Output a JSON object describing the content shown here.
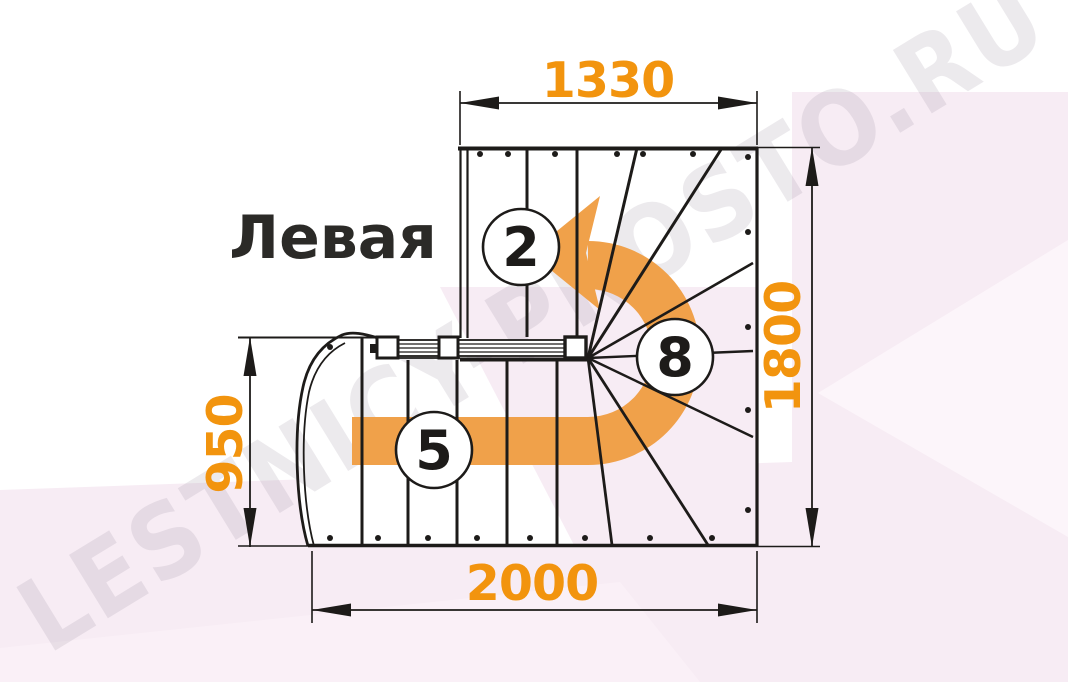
{
  "title": "Левая",
  "watermark": "LESTNICY-PROSTO.RU",
  "colors": {
    "dimension_text_orange": "#f2940e",
    "arrow_orange": "#f0a14a",
    "line_black": "#1d1b19",
    "background_pink": "#f7ecf4",
    "watermark_gray": "#a195a6"
  },
  "dimensions": {
    "top": {
      "value": "1330"
    },
    "right": {
      "value": "1800"
    },
    "left": {
      "value": "950"
    },
    "bottom": {
      "value": "2000"
    }
  },
  "step_labels": {
    "upper_flight": "2",
    "winder": "8",
    "lower_flight": "5"
  }
}
